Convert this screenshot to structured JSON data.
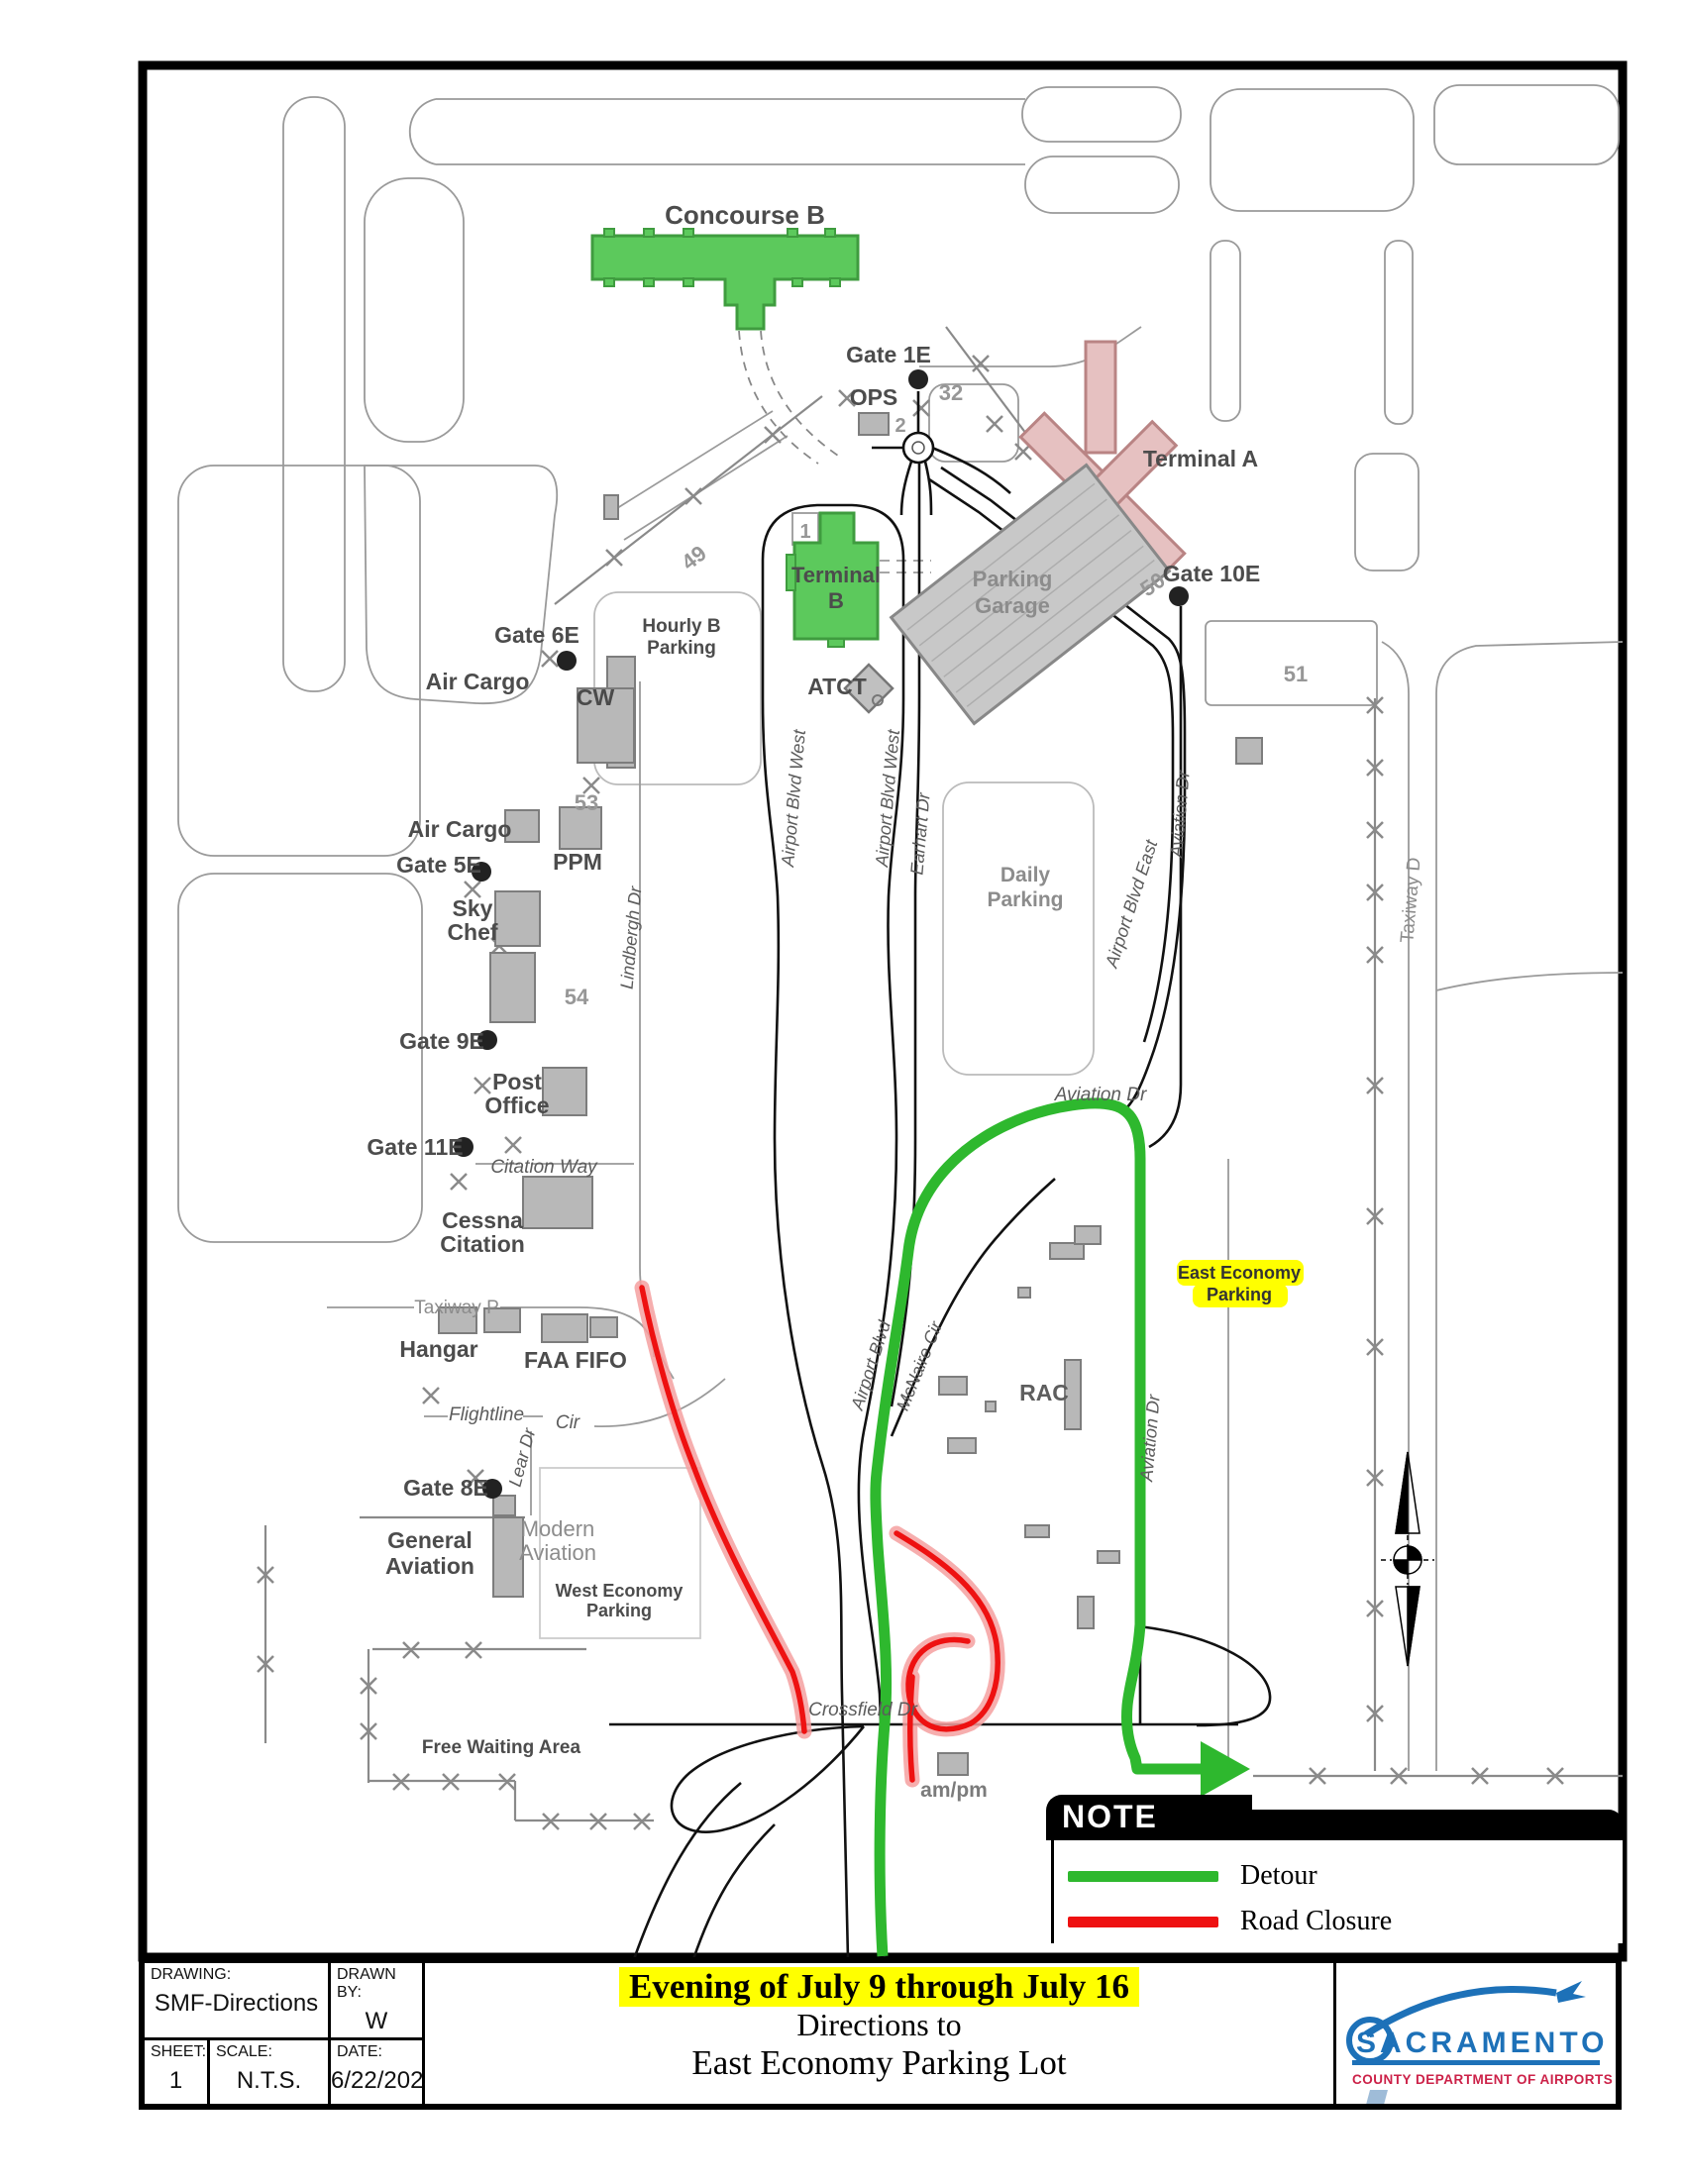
{
  "colors": {
    "building_green": "#5cc95c",
    "terminal_a_pink": "#e6c1c1",
    "garage_gray": "#c8c8c8",
    "detour_green": "#2eb82e",
    "closure_red": "#ee1111",
    "highlight_yellow": "#ffff00",
    "logo_blue": "#1d71b8",
    "logo_red": "#cc2148"
  },
  "labels": {
    "concourse_b": "Concourse B",
    "gate_1e": "Gate 1E",
    "ops": "OPS",
    "num_32": "32",
    "num_2": "2",
    "terminal_a": "Terminal A",
    "terminal_b_l1": "Terminal",
    "terminal_b_l2": "B",
    "num_1": "1",
    "num_49": "49",
    "hourly_l1": "Hourly B",
    "hourly_l2": "Parking",
    "garage_l1": "Parking",
    "garage_l2": "Garage",
    "atct": "ATCT",
    "num_50": "50",
    "gate_10e": "Gate 10E",
    "num_51": "51",
    "gate_6e": "Gate 6E",
    "air_cargo_a": "Air Cargo",
    "cw": "CW",
    "num_53": "53",
    "air_cargo_b": "Air Cargo",
    "gate_5e": "Gate 5E",
    "ppm": "PPM",
    "sky_l1": "Sky",
    "sky_l2": "Chef",
    "num_54": "54",
    "gate_9e": "Gate 9E",
    "post_l1": "Post",
    "post_l2": "Office",
    "gate_11e": "Gate 11E",
    "citation_way": "Citation Way",
    "cessna_l1": "Cessna",
    "cessna_l2": "Citation",
    "taxiway_p": "Taxiway P",
    "hangar": "Hangar",
    "faa_fifo": "FAA FIFO",
    "flightline": "Flightline",
    "cir": "Cir",
    "lear_dr": "Lear Dr",
    "gate_8e": "Gate 8E",
    "general_l1": "General",
    "general_l2": "Aviation",
    "modern_l1": "Modern",
    "modern_l2": "Aviation",
    "west_econ_l1": "West Economy",
    "west_econ_l2": "Parking",
    "free_waiting": "Free Waiting Area",
    "crossfield": "Crossfield Dr",
    "ampm": "am/pm",
    "rac": "RAC",
    "east_econ_l1": "East Economy",
    "east_econ_l2": "Parking",
    "aviation_dr_top": "Aviation Dr",
    "aviation_dr_mid": "Aviation Dr",
    "aviation_dr_low": "Aviation Dr",
    "airport_blvd_east": "Airport Blvd East",
    "airport_blvd": "Airport Blvd",
    "mcnaire_cir": "McNaire Cir",
    "abw_1": "Airport Blvd West",
    "abw_2": "Airport Blvd West",
    "earhart_dr": "Earhart Dr",
    "daily_l1": "Daily",
    "daily_l2": "Parking",
    "lindbergh_dr": "Lindbergh Dr",
    "taxiway_d": "Taxiway D"
  },
  "note": {
    "title": "NOTE",
    "detour_label": "Detour",
    "closure_label": "Road Closure"
  },
  "title_block": {
    "drawing_label": "DRAWING:",
    "drawing_value": "SMF-Directions",
    "drawn_by_label": "DRAWN BY:",
    "drawn_by_value": "W Escobar",
    "sheet_label": "SHEET:",
    "sheet_value": "1",
    "scale_label": "SCALE:",
    "scale_value": "N.T.S.",
    "date_label": "DATE:",
    "date_value": "6/22/2023",
    "title_line1": "Evening of July 9 through July 16",
    "title_line2": "Directions to",
    "title_line3": "East Economy Parking Lot"
  },
  "logo": {
    "name": "SACRAMENTO",
    "subtitle": "COUNTY DEPARTMENT OF AIRPORTS"
  }
}
